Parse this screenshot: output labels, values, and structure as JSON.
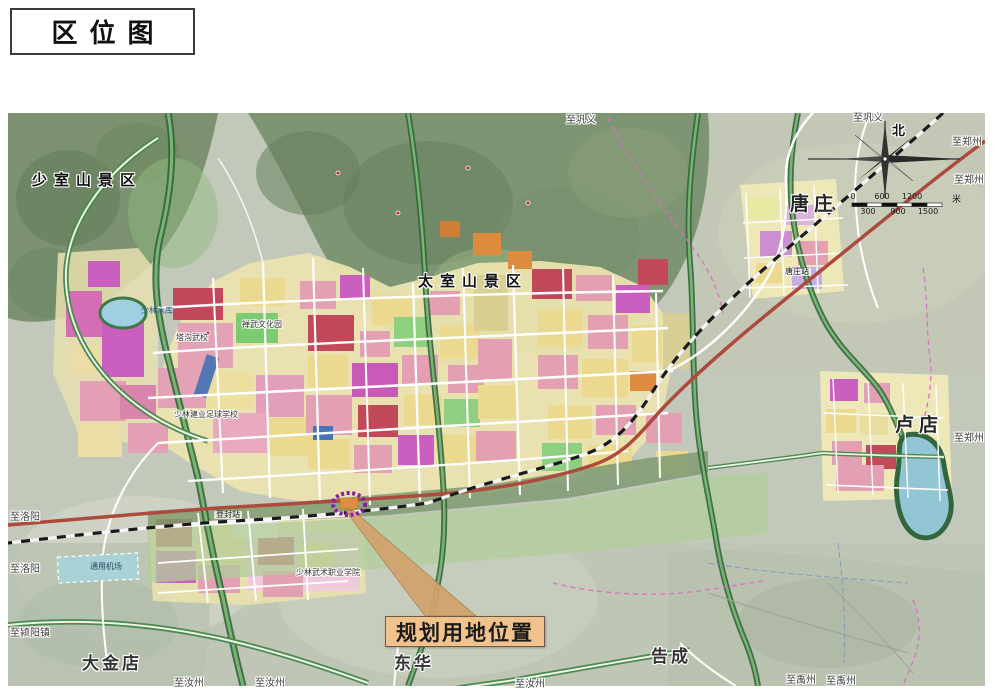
{
  "title": "区位图",
  "palette": {
    "map_base": "#c2c9ba",
    "mountain_green": "#7b9170",
    "urban_yellow": "#ebe3ae",
    "residential_pink": "#e2a0b2",
    "commercial_red": "#c2495a",
    "mixed_magenta": "#cb5fc0",
    "park_green": "#8fd080",
    "water_blue": "#93c6d4",
    "expressway_red": "#ad4a3e",
    "highlight_purple": "#8d1ba6",
    "callout_tan": "#f1c28b"
  },
  "map": {
    "scenic_areas": [
      {
        "label": "少室山景区"
      },
      {
        "label": "太室山景区"
      }
    ],
    "towns": [
      {
        "label": "唐庄"
      },
      {
        "label": "卢店"
      },
      {
        "label": "大金店"
      },
      {
        "label": "东华"
      },
      {
        "label": "告成"
      }
    ],
    "stations": [
      {
        "label": "唐庄站"
      },
      {
        "label": "登封站"
      }
    ],
    "sites": [
      {
        "label": "通用机场"
      },
      {
        "label": "少林水库"
      },
      {
        "label": "塔沟武校"
      },
      {
        "label": "禅武文化园"
      },
      {
        "label": "少林建业足球学校"
      },
      {
        "label": "少林武术职业学院"
      }
    ],
    "edge_labels": [
      {
        "label": "至巩义"
      },
      {
        "label": "至巩义"
      },
      {
        "label": "至郑州"
      },
      {
        "label": "至郑州"
      },
      {
        "label": "至郑州"
      },
      {
        "label": "至洛阳"
      },
      {
        "label": "至洛阳"
      },
      {
        "label": "至颍阳镇"
      },
      {
        "label": "至汝州"
      },
      {
        "label": "至汝州"
      },
      {
        "label": "至汝州"
      },
      {
        "label": "至禹州"
      },
      {
        "label": "至禹州"
      }
    ],
    "callout": {
      "label": "规划用地位置"
    },
    "compass": {
      "north": "北"
    },
    "scale_bar": {
      "top_ticks": [
        "0",
        "600",
        "1200"
      ],
      "bottom_ticks": [
        "300",
        "900",
        "1500"
      ],
      "unit": "米"
    }
  }
}
